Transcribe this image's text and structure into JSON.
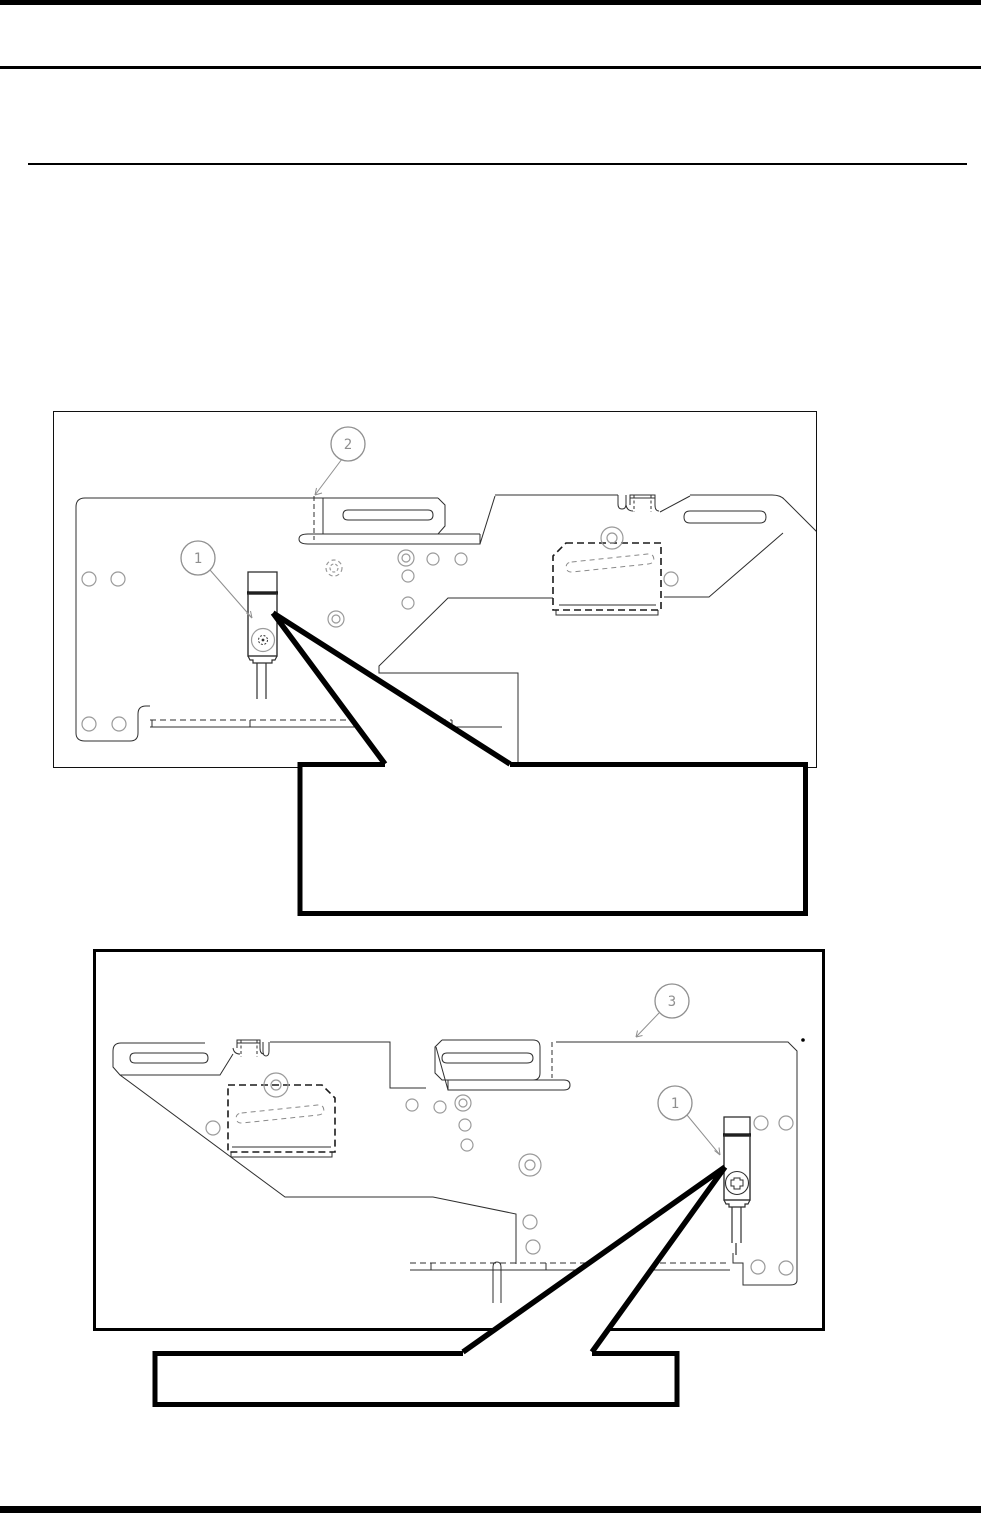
{
  "document": {
    "figures": [
      {
        "name": "figure-1",
        "callouts": [
          {
            "label": "2"
          },
          {
            "label": "1"
          }
        ],
        "callout_box": {
          "text": ""
        }
      },
      {
        "name": "figure-2",
        "callouts": [
          {
            "label": "3"
          },
          {
            "label": "1"
          }
        ],
        "callout_box": {
          "text": ""
        }
      }
    ],
    "colors": {
      "ink": "#000000",
      "drawing_line": "#2f2f2f",
      "hidden_line_gray": "#9a9a9a",
      "balloon_gray": "#8f8f8f",
      "page_bg": "#ffffff"
    }
  }
}
